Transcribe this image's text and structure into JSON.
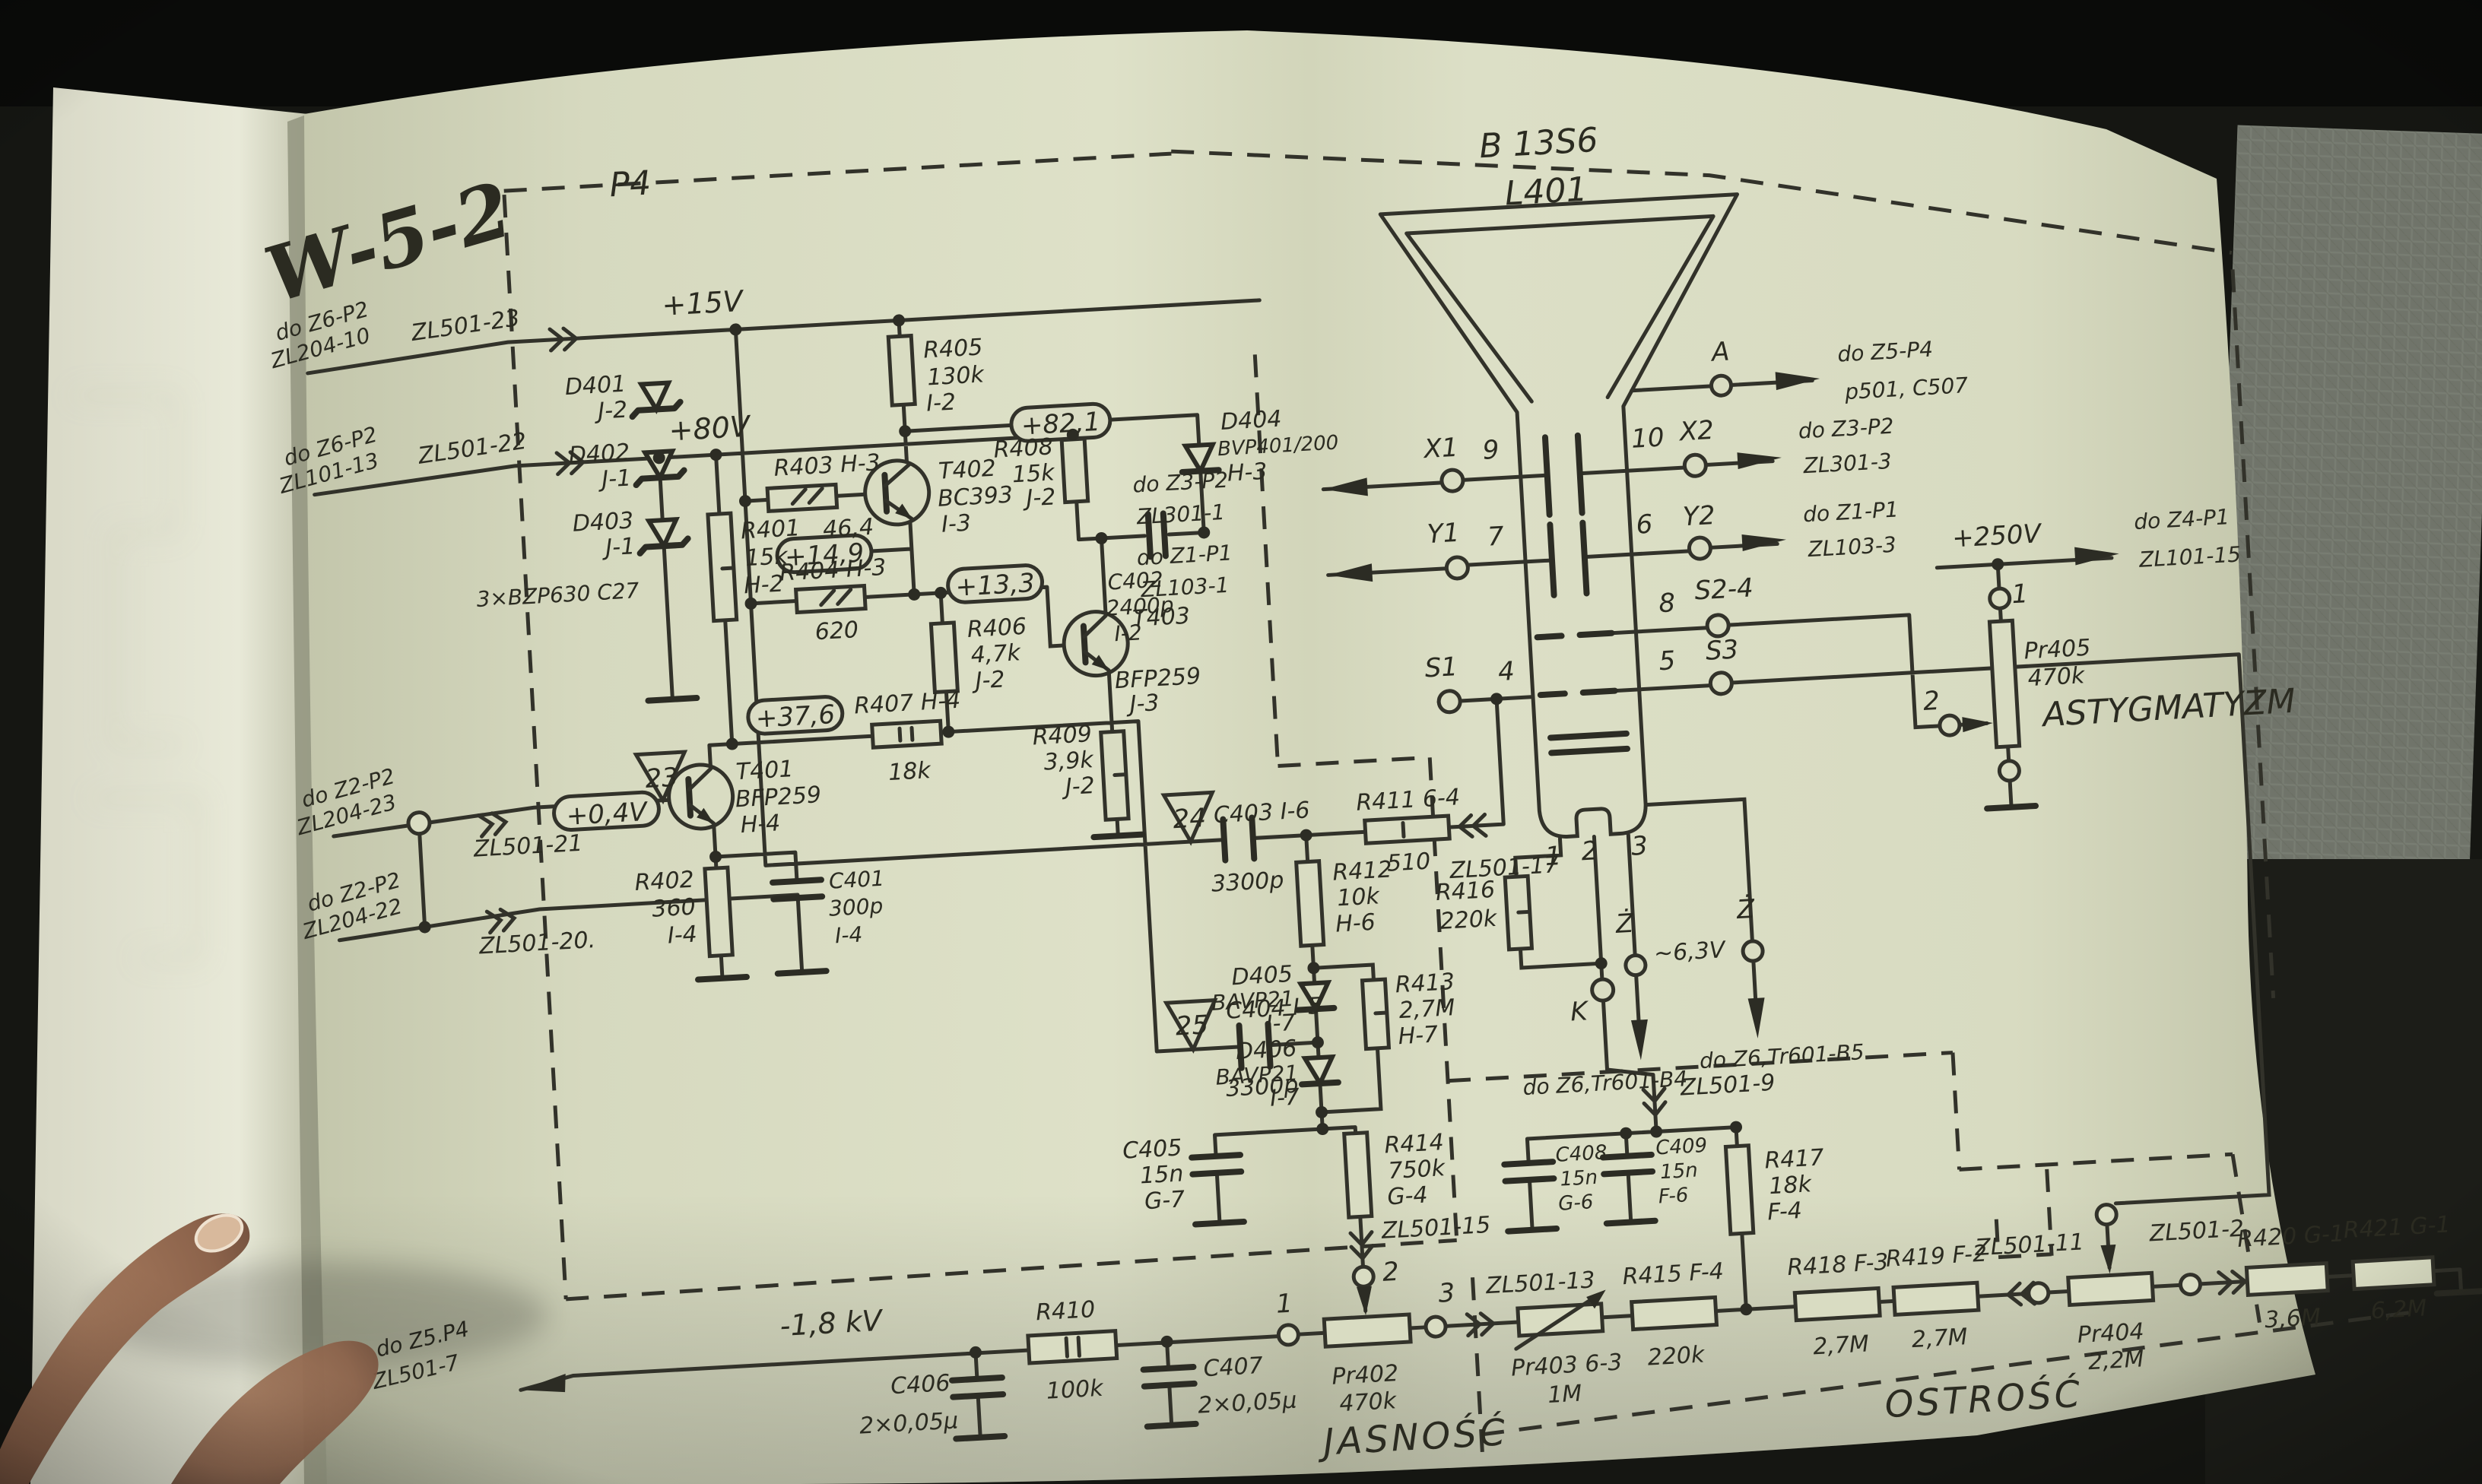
{
  "doc": {
    "title": "W-5-2",
    "module": "P4",
    "brightness": "JASNOŚĆ",
    "focus": "OSTROŚĆ",
    "astig": "ASTYGMATYZM"
  },
  "crt": {
    "type": "B 13S6",
    "ref": "L401",
    "a": "A",
    "x1": "X1",
    "x2": "X2",
    "y1": "Y1",
    "y2": "Y2",
    "s1": "S1",
    "s24": "S2-4",
    "s3": "S3",
    "k": "K",
    "heater": "Ż",
    "heater2": "Ż",
    "heaterv": "~6,3V",
    "p4": "4",
    "p5": "5",
    "p6": "6",
    "p7": "7",
    "p8": "8",
    "p9": "9",
    "p10": "10",
    "b1": "1",
    "b2": "2",
    "b3": "3"
  },
  "sup": {
    "v15": "+15V",
    "v80": "+80V",
    "v250": "+250V",
    "hv": "-1,8 kV"
  },
  "meas": {
    "v821": "+82,1",
    "v149": "+14,9",
    "v133": "+13,3",
    "v376": "+37,6",
    "v04": "+0,4V",
    "t23": "23",
    "t24": "24",
    "t25": "25"
  },
  "con": {
    "c23": "ZL501-23",
    "c22": "ZL501-22",
    "c21": "ZL501-21",
    "c20": "ZL501-20.",
    "c17": "ZL501-17",
    "c15": "ZL501-15",
    "c13": "ZL501-13",
    "c11": "ZL501-11",
    "c9": "ZL501-9",
    "c7": "ZL501-7",
    "c2": "ZL501-2",
    "z6": "do Z6-P2",
    "z6b": "ZL204-10",
    "z6c": "ZL101-13",
    "z2": "do Z2-P2",
    "z2b": "ZL204-23",
    "z2c": "ZL204-22",
    "hv1": "do Z5.P4",
    "x0": "do Z3-P2",
    "x1b": "ZL301-1",
    "x2b": "ZL301-3",
    "y0": "do Z1-P1",
    "y1b": "ZL103-1",
    "y2b": "ZL103-3",
    "aa": "do Z5-P4",
    "ab": "p501, C507",
    "f1": "do Z4-P1",
    "f2": "ZL101-15",
    "h1": "do Z6,Tr601-B4",
    "h2": "do Z6,Tr601-B5"
  },
  "cmp": {
    "r401": [
      "R401",
      "15k",
      "H-2"
    ],
    "r402": [
      "R402",
      "360",
      "I-4"
    ],
    "r403": [
      "R403 H-3",
      "46,4"
    ],
    "r404": [
      "R404 H-3",
      "620"
    ],
    "r405": [
      "R405",
      "130k",
      "I-2"
    ],
    "r406": [
      "R406",
      "4,7k",
      "J-2"
    ],
    "r407": [
      "R407 H-4",
      "18k"
    ],
    "r408": [
      "R408",
      "15k",
      "J-2"
    ],
    "r409": [
      "R409",
      "3,9k",
      "J-2"
    ],
    "r410": [
      "R410",
      "100k"
    ],
    "r411": [
      "R411 6-4",
      "510"
    ],
    "r412": [
      "R412",
      "10k",
      "H-6"
    ],
    "r413": [
      "R413",
      "2,7M",
      "H-7"
    ],
    "r414": [
      "R414",
      "750k",
      "G-4"
    ],
    "r415": [
      "R415 F-4",
      "220k"
    ],
    "r416": [
      "R416",
      "220k"
    ],
    "r417": [
      "R417",
      "18k",
      "F-4"
    ],
    "r418": [
      "R418 F-3",
      "2,7M"
    ],
    "r419": [
      "R419 F-2",
      "2,7M"
    ],
    "r420": [
      "R420 G-1",
      "3,6M"
    ],
    "r421": [
      "R421 G-1",
      "6,2M"
    ],
    "c401": [
      "C401",
      "300p",
      "I-4"
    ],
    "c402": [
      "C402",
      "2400p",
      "I-2"
    ],
    "c403": [
      "C403 I-6",
      "3300p"
    ],
    "c404": [
      "C404 I-5",
      "3300p"
    ],
    "c405": [
      "C405",
      "15n",
      "G-7"
    ],
    "c406": [
      "C406",
      "2×0,05μ"
    ],
    "c407": [
      "C407",
      "2×0,05μ"
    ],
    "c408": [
      "C408",
      "15n",
      "G-6"
    ],
    "c409": [
      "C409",
      "15n",
      "F-6"
    ],
    "d401": [
      "D401",
      "J-2"
    ],
    "d402": [
      "D402",
      "J-1"
    ],
    "d403": [
      "D403",
      "J-1"
    ],
    "dnote": "3×BZP630 C27",
    "d404": [
      "D404",
      "BVP401/200",
      "H-3"
    ],
    "d405": [
      "D405",
      "BAVP21",
      "I-7"
    ],
    "d406": [
      "D406",
      "BAVP21",
      "I-7"
    ],
    "t401": [
      "T401",
      "BFP259",
      "H-4"
    ],
    "t402": [
      "T402",
      "BC393",
      "I-3"
    ],
    "t403": [
      "T403",
      "BFP259",
      "J-3"
    ],
    "pr402": [
      "Pr402",
      "470k"
    ],
    "pr403": [
      "Pr403 6-3",
      "1M"
    ],
    "pr404": [
      "Pr404",
      "2,2M"
    ],
    "pr405": [
      "Pr405",
      "470k"
    ]
  }
}
